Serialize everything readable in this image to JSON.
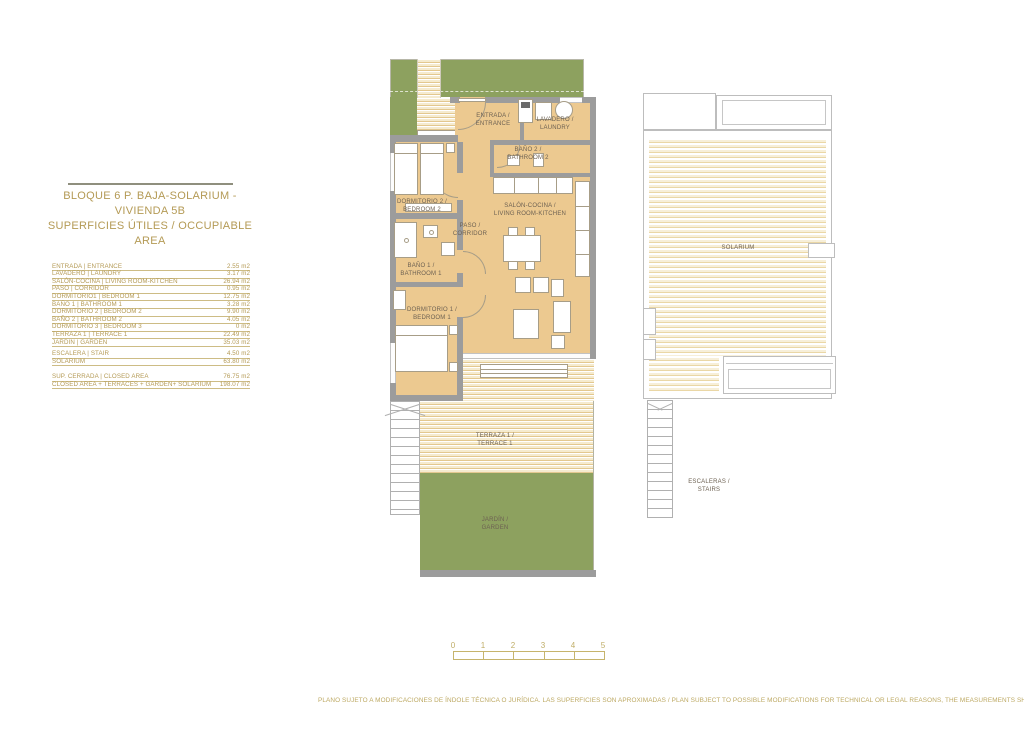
{
  "colors": {
    "accent_gold": "#b49a55",
    "room_tan": "#ecc990",
    "wall_gray": "#9c9c9c",
    "garden_green": "#8da15f",
    "plan_text_gray": "#6d6152"
  },
  "header": {
    "title_line1": "BLOQUE 6 P. BAJA-SOLARIUM - VIVIENDA 5B",
    "title_line2": "SUPERFICIES ÚTILES / OCCUPIABLE AREA"
  },
  "area_table": {
    "rows": [
      {
        "label": "ENTRADA | ENTRANCE",
        "value": "2.55 m2"
      },
      {
        "label": "LAVADERO | LAUNDRY",
        "value": "3.17 m2"
      },
      {
        "label": "SALÓN-COCINA | LIVING ROOM-KITCHEN",
        "value": "26.94 m2"
      },
      {
        "label": "PASO | CORRIDOR",
        "value": "0.95 m2"
      },
      {
        "label": "DORMITORIO1 | BEDROOM 1",
        "value": "12.75 m2"
      },
      {
        "label": "BAÑO 1 | BATHROOM 1",
        "value": "3.28 m2"
      },
      {
        "label": "DORMITORIO 2 | BEDROOM 2",
        "value": "9.90 m2"
      },
      {
        "label": "BAÑO 2 | BATHROOM 2",
        "value": "4.05 m2"
      },
      {
        "label": "DORMITORIO 3 | BEDROOM 3",
        "value": "0 m2"
      },
      {
        "label": "TERRAZA 1 | TERRACE 1",
        "value": "22.49 m2"
      },
      {
        "label": "JARDIN | GARDEN",
        "value": "35.03 m2"
      },
      {
        "label": "ESCALERA | STAIR",
        "value": "4.50 m2",
        "gap_before": true
      },
      {
        "label": "SOLARIUM",
        "value": "63.80 m2"
      }
    ],
    "summary": [
      {
        "label": "SUP. CERRADA | CLOSED AREA",
        "value": "76.75 m2"
      },
      {
        "label": "CLOSED AREA + TERRACES + GARDEN+ SOLARIUM",
        "value": "198.07 m2"
      }
    ]
  },
  "floor_plan": {
    "rooms": {
      "entrada": {
        "label": "ENTRADA /\nENTRANCE"
      },
      "lavadero": {
        "label": "LAVADERO /\nLAUNDRY"
      },
      "bano2": {
        "label": "BAÑO 2 /\nBATHROOM 2"
      },
      "dormitorio2": {
        "label": "DORMITORIO 2 /\nBEDROOM 2"
      },
      "paso": {
        "label": "PASO /\nCORRIDOR"
      },
      "salon": {
        "label": "SALÓN-COCINA /\nLIVING ROOM-KITCHEN"
      },
      "bano1": {
        "label": "BAÑO 1 /\nBATHROOM 1"
      },
      "dormitorio1": {
        "label": "DORMITORIO 1 /\nBEDROOM 1"
      },
      "terraza1": {
        "label": "TERRAZA 1 /\nTERRACE 1"
      },
      "jardin": {
        "label": "JARDÍN /\nGARDEN"
      }
    }
  },
  "solarium_plan": {
    "solarium_label": "SOLARIUM",
    "stairs_label": "ESCALERAS /\nSTAIRS"
  },
  "scale_bar": {
    "ticks": [
      "0",
      "1",
      "2",
      "3",
      "4",
      "5"
    ]
  },
  "footer": {
    "disclaimer": "PLANO SUJETO A MODIFICACIONES DE ÍNDOLE TÉCNICA O JURÍDICA. LAS SUPERFICIES SON APROXIMADAS / PLAN SUBJECT TO POSSIBLE MODIFICATIONS FOR TECHNICAL OR LEGAL REASONS, THE MEASUREMENTS SHOWN ARE APPROXIMATE"
  }
}
